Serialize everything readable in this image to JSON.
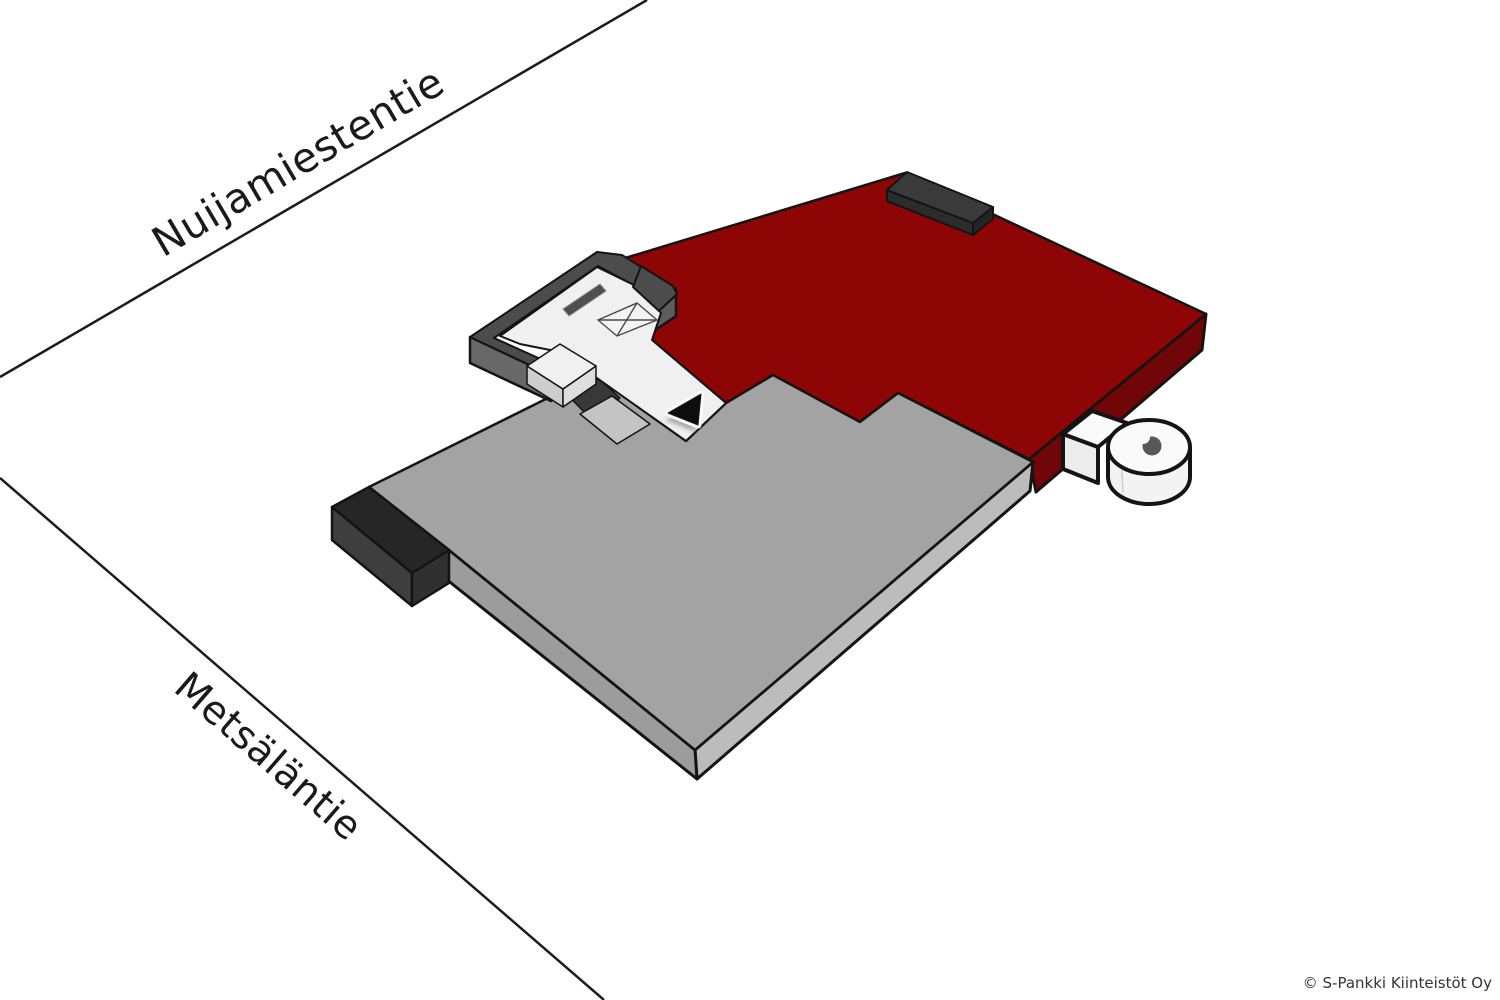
{
  "diagram": {
    "streets": {
      "top_label": "Nuijamiestentie",
      "bottom_label": "Metsäläntie"
    },
    "watermark": "© S-Pankki Kiinteistöt Oy",
    "colors": {
      "background": "#ffffff",
      "street_line": "#1c1c1c",
      "street_text": "#1a1a1a",
      "outline": "#141414",
      "roof_red_top": "#8e0505",
      "roof_red_side": "#700607",
      "roof_gray_top": "#a3a3a3",
      "roof_gray_side_se": "#bcbcbc",
      "roof_gray_side_sw": "#9c9c9c",
      "dark_block_top": "#262626",
      "dark_block_side_left": "#3e3e3e",
      "dark_block_side_front": "#303030",
      "roof_block_top": "#3a3a3a",
      "roof_block_front": "#2c2c2c",
      "roof_block_end": "#242424",
      "entrance_frame": "#4c4c4c",
      "entrance_frame_side_sw": "#686868",
      "entrance_frame_side_se": "#5d5d5d",
      "walkway_white": "#f0f0f0",
      "walkway_step_light": "#c4c4c4",
      "walkway_shadow_band": "#383838",
      "landing_face_left": "#cdcdcd",
      "landing_face_right": "#dedede",
      "window_slot": "#4f4f4f",
      "marker_black": "#0d0d0d",
      "tower_top": "#fafafa",
      "tower_body": "#f3f3f3",
      "tower_connector_front": "#ececec",
      "tower_hatch": "#585858",
      "watermark_text": "#333333"
    }
  }
}
